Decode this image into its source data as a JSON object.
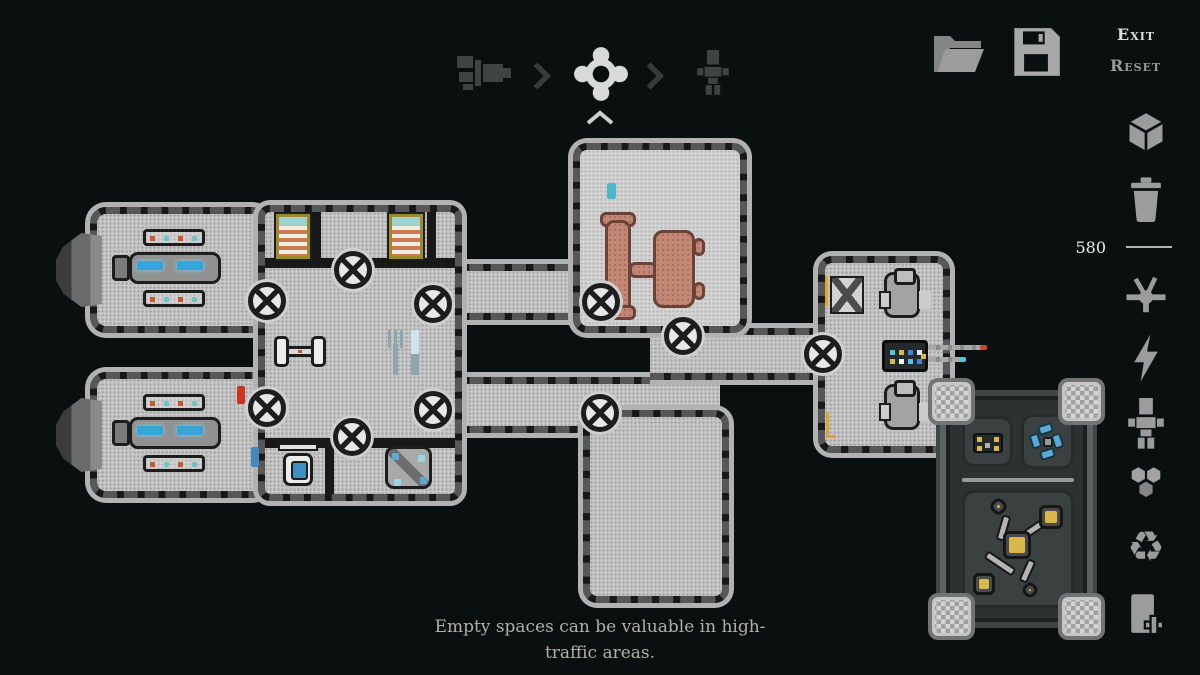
{
  "top_nav": {
    "steps": [
      {
        "icon": "ship-exterior-icon",
        "active": false
      },
      {
        "icon": "ship-systems-gear-icon",
        "active": true
      },
      {
        "icon": "crew-icon",
        "active": false
      }
    ],
    "separator_icon": "chevron-right-icon",
    "collapse_icon": "chevron-up-icon"
  },
  "file_actions": {
    "open_icon": "folder-open-icon",
    "save_icon": "save-disk-icon"
  },
  "menu": {
    "exit_label": "Exit",
    "reset_label": "Reset"
  },
  "tool_sidebar": {
    "resource_count": "580",
    "tools_above_counter": [
      {
        "name": "build-block-tool",
        "icon": "cube-icon"
      },
      {
        "name": "delete-tool",
        "icon": "trash-icon"
      }
    ],
    "tools_below_counter": [
      {
        "name": "piping-tool",
        "icon": "pipe-junction-icon"
      },
      {
        "name": "power-tool",
        "icon": "lightning-icon"
      },
      {
        "name": "crew-tool",
        "icon": "pixel-person-icon"
      },
      {
        "name": "tiles-tool",
        "icon": "hexagons-icon"
      },
      {
        "name": "recycle-tool",
        "icon": "recycle-icon"
      },
      {
        "name": "door-tool",
        "icon": "door-add-icon"
      }
    ]
  },
  "hint": {
    "text": "Empty spaces can be valuable in high-traffic areas."
  },
  "ship": {
    "rooms": [
      "engine-room-top",
      "engine-room-bottom",
      "central-quarters",
      "bridge-room",
      "empty-bottom-room",
      "cockpit-room",
      "upper-corridor",
      "lower-corridor",
      "right-corridor",
      "external-systems-module"
    ],
    "objects": [
      "thruster",
      "engine-block",
      "bunk-bed",
      "dumbbell",
      "fork",
      "knife",
      "toilet",
      "recycler-machine",
      "captain-table",
      "pilot-chair",
      "control-console",
      "antenna",
      "scanner-machine",
      "generator",
      "fan-unit",
      "pipe-network"
    ]
  },
  "colors": {
    "background": "#0a1010",
    "floor": "#c7c7c7",
    "wall": "#181818",
    "hull_rim": "#b2b2b2",
    "engine_glow": "#36a6da",
    "flame": "#eda93c",
    "table": "#c28775",
    "accent_yellow": "#d8b84a",
    "accent_blue": "#5aa8d8",
    "icon_gray": "#9c9c9c",
    "active_icon": "#d9d9d9",
    "text_bright": "#dcdcdc",
    "text_dim": "#9b9b9b",
    "hint_text": "#b3afa7"
  }
}
